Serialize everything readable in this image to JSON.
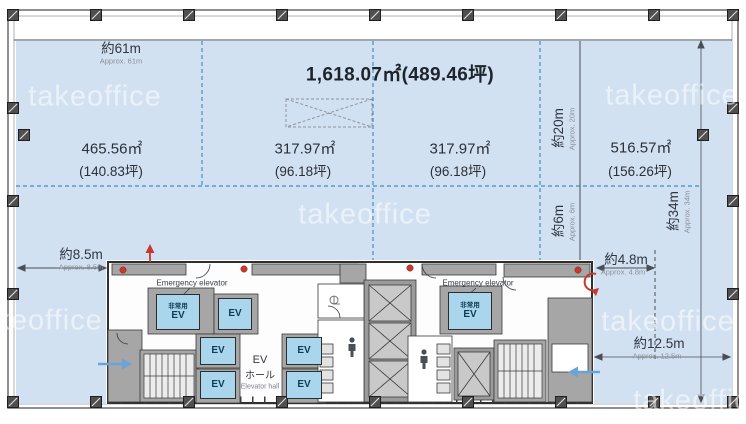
{
  "page": {
    "total_area": "1,618.07㎡(489.46坪)",
    "watermark": "takeoffice"
  },
  "areas": {
    "left": {
      "m2": "465.56㎡",
      "tsubo": "(140.83坪)"
    },
    "center_left": {
      "m2": "317.97㎡",
      "tsubo": "(96.18坪)"
    },
    "center_right": {
      "m2": "317.97㎡",
      "tsubo": "(96.18坪)"
    },
    "right": {
      "m2": "516.57㎡",
      "tsubo": "(156.26坪)"
    }
  },
  "dimensions": {
    "top_width": {
      "jp": "約61m",
      "en": "Approx. 61m"
    },
    "right_depth_upper": {
      "jp": "約20m",
      "en": "Approx. 20m"
    },
    "right_depth_gap": {
      "jp": "約6m",
      "en": "Approx. 6m"
    },
    "right_total_depth": {
      "jp": "約34m",
      "en": "Approx. 34m"
    },
    "left_offset": {
      "jp": "約8.5m",
      "en": "Approx. 8.5m"
    },
    "right_offset": {
      "jp": "約4.8m",
      "en": "Approx. 4.8m"
    },
    "bottom_right_width": {
      "jp": "約12.5m",
      "en": "Approx. 12.5m"
    }
  },
  "core": {
    "emergency_elevator_label": "Emergency elevator",
    "emergency_ev": {
      "line1": "非常用",
      "line2": "EV"
    },
    "ev": "EV",
    "ev_hall": {
      "line1": "EV",
      "line2": "ホール",
      "line3": "Elevator hall"
    }
  },
  "colors": {
    "office_zone": "#d2e1f1",
    "divider_blue": "#3f8ec9",
    "elevator_fill": "#a9d6ec",
    "wall_gray": "#a6a6a6",
    "accent_red": "#c6392f",
    "arrow_blue": "#6aa3d8"
  }
}
